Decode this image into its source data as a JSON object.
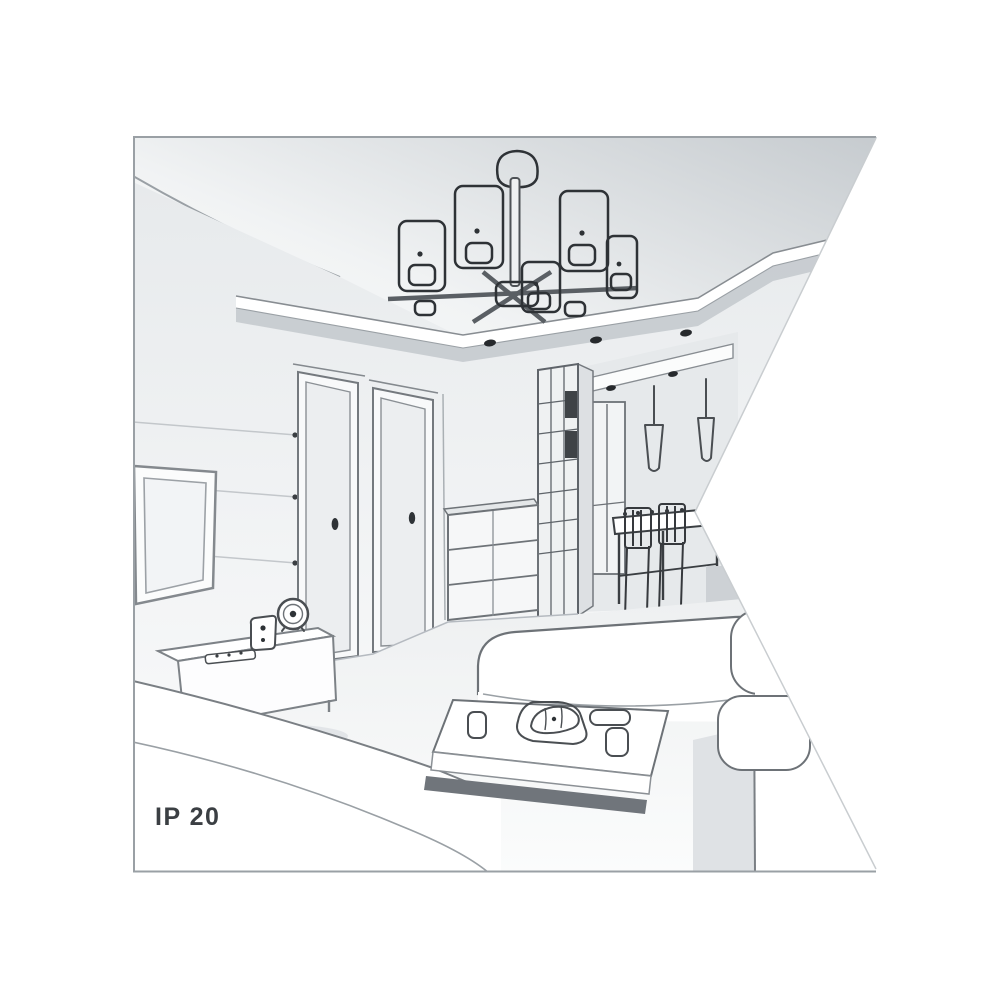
{
  "page": {
    "background": "#ffffff"
  },
  "illustration": {
    "type": "interior-line-drawing",
    "label": "IP 20",
    "label_color": "#3b3f43",
    "frame_color": "#9aa0a5",
    "line_color": "#6d7277",
    "dark_line_color": "#2e3236",
    "ceiling_shade": "#c8cdd1",
    "wall_shade": "#edeff1",
    "shadow_shade": "#70757b",
    "objects": [
      "chandelier",
      "drop-ceiling-panel",
      "recessed-spotlights",
      "tv",
      "tv-wall-panels",
      "door",
      "door",
      "sideboard",
      "remote",
      "speaker",
      "clock",
      "dresser",
      "glass-wardrobe",
      "hallway",
      "pendant-lights",
      "window",
      "dining-table",
      "dining-chairs",
      "chaise-sofa",
      "back-sofa",
      "right-sofa",
      "coffee-table",
      "cup",
      "croissant-plate",
      "dish",
      "floor"
    ]
  }
}
